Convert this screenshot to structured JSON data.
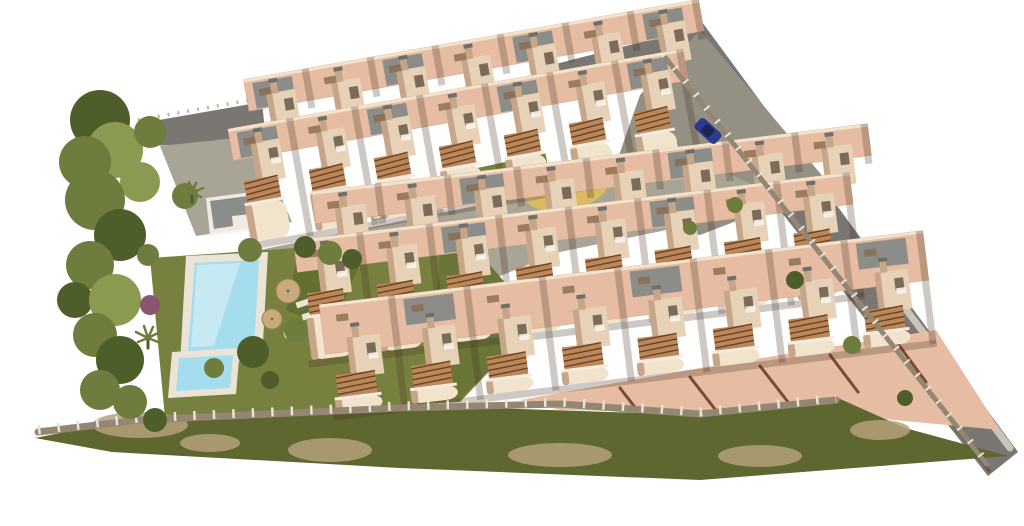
{
  "scene": {
    "kind": "architectural-aerial-render",
    "subject": "terraced apartment complex with communal pool, playground, perimeter roads and landscaping",
    "background": "#ffffff"
  },
  "palette": {
    "wall": "#e7d2b8",
    "wall_light": "#f2e3cd",
    "wall_shadow": "#c5a689",
    "terrace": "#e6bca2",
    "terrace_dark": "#d3a289",
    "roof_gray": "#8c8c88",
    "roof_dark": "#6e6e6a",
    "road": "#7a7672",
    "road_dark": "#5e5a56",
    "road_light": "#c9c4ba",
    "plaza": "#949084",
    "paving": "#a8a496",
    "lawn": "#77803e",
    "lawn_dark": "#5d692f",
    "tree": "#6e7c3e",
    "tree_dark": "#4e5e2a",
    "tree_light": "#8a9a50",
    "purple_bush": "#8a5570",
    "scrub": "#5d672f",
    "scrub_tan": "#b4a178",
    "pool_water": "#a5dcee",
    "pool_light": "#d8f0f8",
    "deck": "#e9e4d6",
    "sand": "#dabb60",
    "pergola": "#b9885a",
    "pergola_line": "#6f3f22",
    "divider": "#7a4a33",
    "wall_fence": "#938672",
    "fence_post": "#eae3d3",
    "car_blue": "#2c3b8e",
    "umbrella": "#c8aa7c"
  },
  "objects": {
    "building_row_count": 3,
    "apartment_units_visible": 23,
    "main_pool": "rectangular communal pool",
    "kids_pool": "small splash pool",
    "playground": "sand circle with play structure",
    "parked_car": "blue car on east access road",
    "umbrella_count": 2,
    "perimeter": "stone wall with railing over scrub slope"
  },
  "building_rows": [
    {
      "name": "building-row-top",
      "x": 240,
      "y": 198,
      "rotation": -10,
      "units": 7,
      "unit_width": 66,
      "top_y": -70,
      "bottom_y": 50,
      "layers": 2,
      "gray_roof_modulo": 2,
      "gray_roof_offset": 0
    },
    {
      "name": "building-row-middle",
      "x": 302,
      "y": 310,
      "rotation": -7,
      "units": 8,
      "unit_width": 70,
      "top_y": -70,
      "bottom_y": 55,
      "layers": 2,
      "gray_roof_modulo": 3,
      "gray_roof_offset": 1
    },
    {
      "name": "building-row-bottom",
      "x": 330,
      "y": 392,
      "rotation": -7,
      "units": 8,
      "unit_width": 76,
      "top_y": -88,
      "bottom_y": 26,
      "layers": 1,
      "gray_roof_modulo": 3,
      "gray_roof_offset": 2
    }
  ],
  "vegetation": {
    "trees": [
      [
        100,
        120,
        30,
        "d"
      ],
      [
        115,
        150,
        28,
        "l"
      ],
      [
        85,
        162,
        26,
        "m"
      ],
      [
        150,
        132,
        16,
        "m"
      ],
      [
        140,
        182,
        20,
        "l"
      ],
      [
        95,
        200,
        30,
        "m"
      ],
      [
        120,
        235,
        26,
        "d"
      ],
      [
        90,
        265,
        24,
        "m"
      ],
      [
        75,
        300,
        18,
        "d"
      ],
      [
        115,
        300,
        26,
        "l"
      ],
      [
        95,
        335,
        22,
        "m"
      ],
      [
        120,
        360,
        24,
        "d"
      ],
      [
        100,
        390,
        20,
        "m"
      ],
      [
        130,
        402,
        17,
        "m"
      ],
      [
        155,
        420,
        12,
        "d"
      ],
      [
        185,
        196,
        13,
        "m"
      ],
      [
        150,
        305,
        10,
        "p"
      ],
      [
        148,
        255,
        11,
        "m"
      ],
      [
        250,
        250,
        12,
        "m"
      ],
      [
        305,
        247,
        11,
        "d"
      ],
      [
        330,
        253,
        12,
        "m"
      ],
      [
        352,
        259,
        10,
        "d"
      ],
      [
        253,
        352,
        16,
        "d"
      ],
      [
        214,
        368,
        10,
        "m"
      ],
      [
        296,
        330,
        12,
        "m"
      ],
      [
        270,
        380,
        9,
        "d"
      ],
      [
        735,
        205,
        8,
        "m"
      ],
      [
        795,
        280,
        9,
        "d"
      ],
      [
        852,
        345,
        9,
        "m"
      ],
      [
        905,
        398,
        8,
        "d"
      ],
      [
        690,
        228,
        7,
        "m"
      ]
    ],
    "scrub_patches": [
      [
        140,
        425,
        48,
        13
      ],
      [
        330,
        450,
        42,
        12
      ],
      [
        560,
        455,
        52,
        12
      ],
      [
        760,
        456,
        42,
        11
      ],
      [
        880,
        430,
        30,
        10
      ],
      [
        210,
        443,
        30,
        9
      ]
    ]
  }
}
